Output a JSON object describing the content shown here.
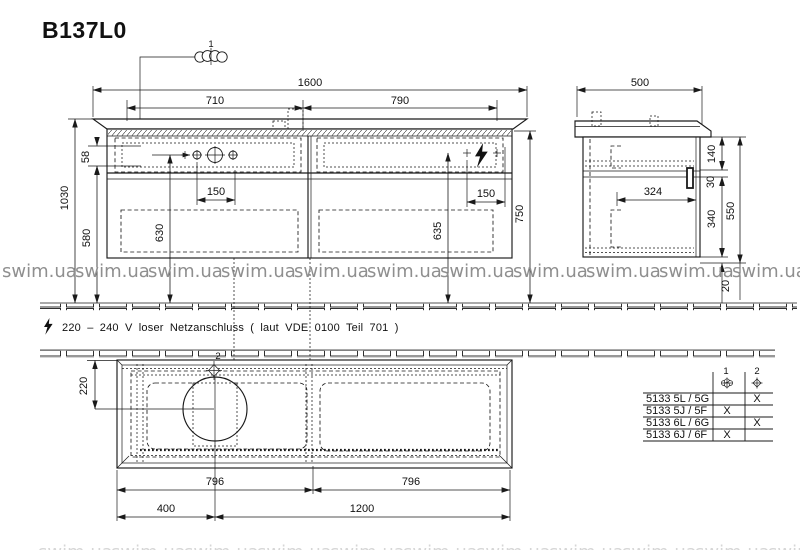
{
  "title": "B137L0",
  "colors": {
    "ink": "#1a1a1a",
    "watermark": "#8f8f8f"
  },
  "watermark": {
    "text": "swim.ua"
  },
  "note": {
    "icon": "lightning-bolt",
    "text": "220 – 240 V loser Netzanschluss ( laut VDE 0100 Teil 701 )"
  },
  "callouts": {
    "c1": "1",
    "c2": "2"
  },
  "front_view": {
    "dims": {
      "width_total": "1600",
      "width_left": "710",
      "width_right": "790",
      "top_strip": "58",
      "height_total": "1030",
      "height_floor_gap": "580",
      "drawer_left_depth": "630",
      "drawer_right_depth": "635",
      "hole_offset_left": "150",
      "hole_offset_right": "150",
      "cabinet_height": "750"
    }
  },
  "side_view": {
    "dims": {
      "depth": "500",
      "top_drawer": "140",
      "gap": "30",
      "height": "550",
      "inner_depth": "324",
      "bottom_drawer": "340",
      "recess": "20"
    }
  },
  "plan_view": {
    "dims": {
      "drain_offset": "220",
      "half_left": "796",
      "half_right": "796",
      "seg_left": "400",
      "seg_right": "1200"
    }
  },
  "table": {
    "headers": [
      "1",
      "2"
    ],
    "rows": [
      {
        "model": "5133 5L / 5G",
        "c1": "",
        "c2": "X"
      },
      {
        "model": "5133 5J / 5F",
        "c1": "X",
        "c2": ""
      },
      {
        "model": "5133 6L / 6G",
        "c1": "",
        "c2": "X"
      },
      {
        "model": "5133 6J / 6F",
        "c1": "X",
        "c2": ""
      }
    ]
  }
}
